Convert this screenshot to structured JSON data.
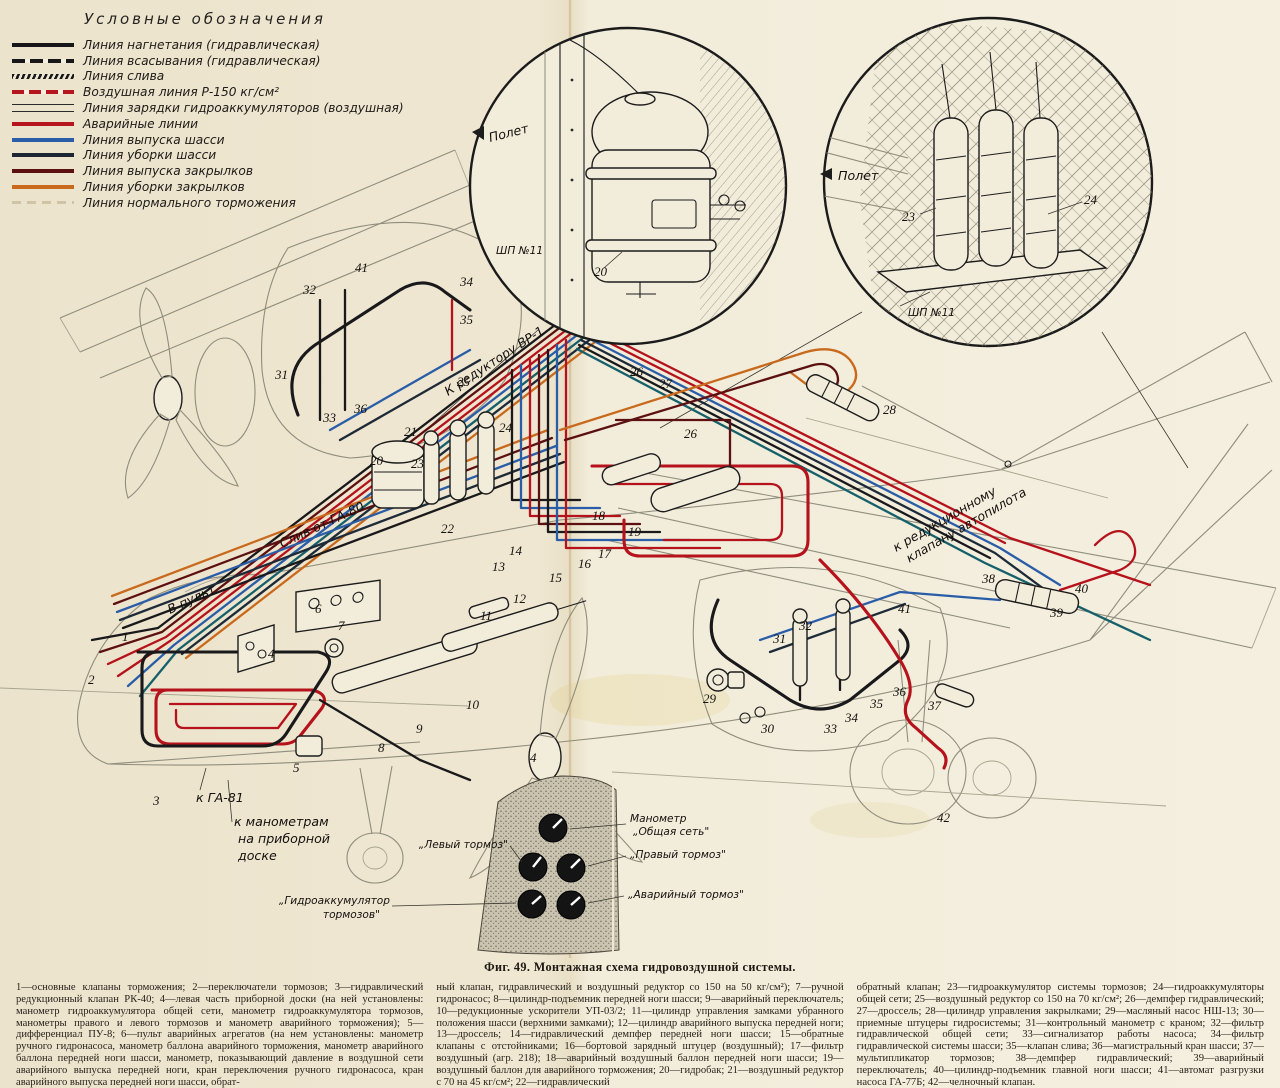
{
  "legend": {
    "title": "Условные обозначения",
    "items": [
      {
        "label": "Линия нагнетания (гидравлическая)",
        "style": "solid-black"
      },
      {
        "label": "Линия всасывания (гидравлическая)",
        "style": "dashed-black"
      },
      {
        "label": "Линия слива",
        "style": "hatched-black"
      },
      {
        "label": "Воздушная линия  Р-150 кг/см²",
        "style": "dashed-red"
      },
      {
        "label": "Линия зарядки гидроаккумуляторов (воздушная)",
        "style": "double-thin"
      },
      {
        "label": "Аварийные линии",
        "style": "solid-red"
      },
      {
        "label": "Линия выпуска шасси",
        "style": "solid-blue"
      },
      {
        "label": "Линия уборки шасси",
        "style": "solid-navy"
      },
      {
        "label": "Линия выпуска закрылков",
        "style": "solid-maroon"
      },
      {
        "label": "Линия уборки закрылков",
        "style": "solid-orange"
      },
      {
        "label": "Линия нормального торможения",
        "style": "faint"
      }
    ]
  },
  "colors": {
    "paper": "#efe7d2",
    "black_line": "#19191b",
    "red_line": "#b5121b",
    "maroon_line": "#5c1010",
    "blue_line": "#2a5da8",
    "navy_line": "#1d2a38",
    "teal_line": "#15606a",
    "orange_line": "#c8691c"
  },
  "insets": {
    "tank": {
      "part_label": "20",
      "frame_label": "ШП №11",
      "direction_label": "Полет"
    },
    "accumulators": {
      "left_label": "23",
      "right_label": "24",
      "frame_label": "ШП №11",
      "direction_label": "Полет"
    }
  },
  "diagram": {
    "labels": {
      "to_reducer": "К редуктору ВР-1",
      "drain": "Слив от ГА-80",
      "to_console": "В пульт",
      "to_ga81": "к ГА-81",
      "to_gauges_1": "к манометрам",
      "to_gauges_2": "на приборной",
      "to_gauges_3": "доске",
      "autopilot_1": "к редукционному",
      "autopilot_2": "клапану автопилота"
    },
    "callouts": [
      {
        "n": "1",
        "x": 122,
        "y": 641
      },
      {
        "n": "2",
        "x": 88,
        "y": 684
      },
      {
        "n": "3",
        "x": 153,
        "y": 805
      },
      {
        "n": "4",
        "x": 268,
        "y": 658
      },
      {
        "n": "4",
        "x": 530,
        "y": 762
      },
      {
        "n": "5",
        "x": 293,
        "y": 772
      },
      {
        "n": "6",
        "x": 315,
        "y": 613
      },
      {
        "n": "7",
        "x": 338,
        "y": 630
      },
      {
        "n": "8",
        "x": 378,
        "y": 752
      },
      {
        "n": "9",
        "x": 416,
        "y": 733
      },
      {
        "n": "10",
        "x": 466,
        "y": 709
      },
      {
        "n": "11",
        "x": 480,
        "y": 620
      },
      {
        "n": "12",
        "x": 513,
        "y": 603
      },
      {
        "n": "13",
        "x": 492,
        "y": 571
      },
      {
        "n": "14",
        "x": 509,
        "y": 555
      },
      {
        "n": "15",
        "x": 549,
        "y": 582
      },
      {
        "n": "16",
        "x": 578,
        "y": 568
      },
      {
        "n": "17",
        "x": 598,
        "y": 558
      },
      {
        "n": "18",
        "x": 592,
        "y": 520
      },
      {
        "n": "19",
        "x": 628,
        "y": 536
      },
      {
        "n": "20",
        "x": 370,
        "y": 465
      },
      {
        "n": "21",
        "x": 404,
        "y": 436
      },
      {
        "n": "22",
        "x": 441,
        "y": 533
      },
      {
        "n": "23",
        "x": 411,
        "y": 468
      },
      {
        "n": "24",
        "x": 499,
        "y": 432
      },
      {
        "n": "25",
        "x": 457,
        "y": 386
      },
      {
        "n": "26",
        "x": 630,
        "y": 376
      },
      {
        "n": "27",
        "x": 659,
        "y": 388
      },
      {
        "n": "26",
        "x": 684,
        "y": 438
      },
      {
        "n": "28",
        "x": 883,
        "y": 414
      },
      {
        "n": "29",
        "x": 703,
        "y": 703
      },
      {
        "n": "30",
        "x": 761,
        "y": 733
      },
      {
        "n": "31",
        "x": 275,
        "y": 379
      },
      {
        "n": "32",
        "x": 303,
        "y": 294
      },
      {
        "n": "33",
        "x": 323,
        "y": 422
      },
      {
        "n": "34",
        "x": 460,
        "y": 286
      },
      {
        "n": "35",
        "x": 460,
        "y": 324
      },
      {
        "n": "36",
        "x": 354,
        "y": 413
      },
      {
        "n": "41",
        "x": 355,
        "y": 272
      },
      {
        "n": "31",
        "x": 773,
        "y": 643
      },
      {
        "n": "32",
        "x": 799,
        "y": 630
      },
      {
        "n": "33",
        "x": 824,
        "y": 733
      },
      {
        "n": "34",
        "x": 845,
        "y": 722
      },
      {
        "n": "35",
        "x": 870,
        "y": 708
      },
      {
        "n": "36",
        "x": 893,
        "y": 696
      },
      {
        "n": "37",
        "x": 928,
        "y": 710
      },
      {
        "n": "38",
        "x": 982,
        "y": 583
      },
      {
        "n": "39",
        "x": 1050,
        "y": 617
      },
      {
        "n": "40",
        "x": 1075,
        "y": 593
      },
      {
        "n": "41",
        "x": 898,
        "y": 613
      },
      {
        "n": "42",
        "x": 937,
        "y": 822
      }
    ]
  },
  "gauge_panel": {
    "labels": {
      "common_1": "Манометр",
      "common_2": "„Общая сеть\"",
      "left": "„Левый тормоз\"",
      "right": "„Правый тормоз\"",
      "emergency": "„Аварийный тормоз\"",
      "accum_1": "„Гидроаккумулятор",
      "accum_2": "тормозов\""
    }
  },
  "caption": "Фиг. 49. Монтажная схема гидровоздушной системы.",
  "footnotes": {
    "col1": "1—основные клапаны торможения; 2—переключатели тормозов; 3—гидравлический редукционный клапан РК-40; 4—левая часть приборной доски (на ней установлены: манометр гидроаккумулятора общей сети, манометр гидроаккумулятора тормозов, манометры правого и левого тормозов и манометр аварийного торможения); 5—дифференциал ПУ-8; 6—пульт аварийных агрегатов (на нем установлены: манометр ручного гидронасоса, манометр баллона аварийного торможения, манометр аварийного баллона передней ноги шасси, манометр, показывающий давление в воздушной сети аварийного выпуска передней ноги, кран переключения ручного гидронасоса, кран аварийного выпуска передней ноги шасси, обрат-",
    "col2": "ный клапан, гидравлический и воздушный редуктор со 150 на 50 кг/см²); 7—ручной гидронасос; 8—цилиндр-подъемник передней ноги шасси; 9—аварийный переключатель; 10—редукционные ускорители УП-03/2; 11—цилиндр управления замками убранного положения шасси (верхними замками); 12—цилиндр аварийного выпуска передней ноги; 13—дроссель; 14—гидравлический демпфер передней ноги шасси; 15—обратные клапаны с отстойниками; 16—бортовой зарядный штуцер (воздушный); 17—фильтр воздушный (агр. 218); 18—аварийный воздушный баллон передней ноги шасси; 19—воздушный баллон для аварийного торможения; 20—гидробак; 21—воздушный редуктор с 70 на 45 кг/см²; 22—гидравлический",
    "col3": "обратный клапан; 23—гидроаккумулятор системы тормозов; 24—гидроаккумуляторы общей сети; 25—воздушный редуктор со 150 на 70 кг/см²; 26—демпфер гидравлический; 27—дроссель; 28—цилиндр управления закрылками; 29—масляный насос НШ-13; 30—приемные штуцеры гидросистемы; 31—контрольный манометр с краном; 32—фильтр гидравлической общей сети; 33—сигнализатор работы насоса; 34—фильтр гидравлической системы шасси; 35—клапан слива; 36—магистральный кран шасси; 37—мультипликатор тормозов; 38—демпфер гидравлический; 39—аварийный переключатель; 40—цилиндр-подъемник главной ноги шасси; 41—автомат разгрузки насоса ГА-77Б; 42—челночный клапан."
  }
}
